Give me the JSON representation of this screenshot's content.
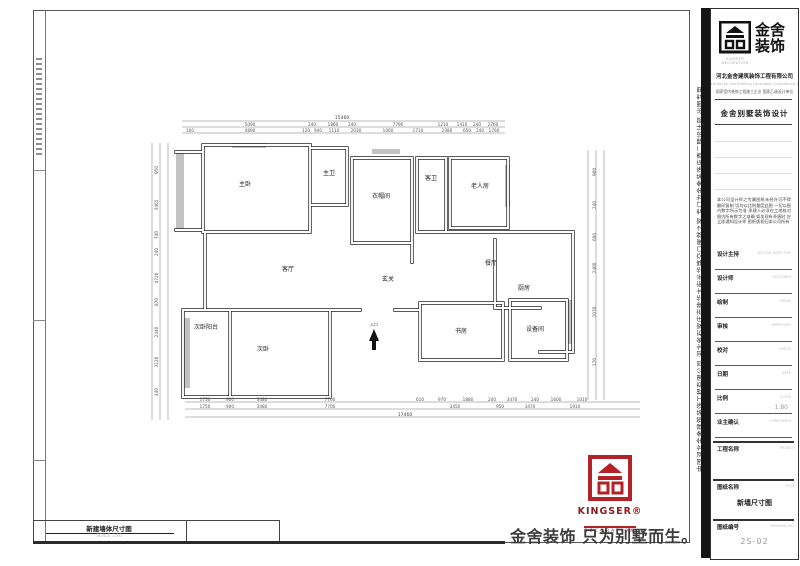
{
  "side_strip": {
    "text": "中国河北金舍建筑装饰工程有限公司  河北省石家庄市建华大街光华路交口居然之家  专门为金舍装饰店面二期设计部  出图专用"
  },
  "title_block": {
    "brand_line1": "金舍",
    "brand_line2": "装饰",
    "logo_sub": "KINGSER DECORATION",
    "company_cn": "河北金舍建筑装饰工程有限公司",
    "company_en": "He Bei Jin She Building Decoration Engineering Co.,Ltd.",
    "qualification": "国家室内装饰工程施工企业 国家乙级设计单位",
    "dept_title": "金舍别墅装饰设计",
    "notice": "本公司设计师之专属图纸未经许可不得翻印复制 切勿以比例量度此图 一切以图内数字所示为准 承建人必须在工地核对图内所有数字之准确 如发现有矛盾时 应立即通知设计师 图纸版权归本公司所有",
    "fields": [
      {
        "label": "设计主持",
        "en": "DESIGN DIRECTOR",
        "value": ""
      },
      {
        "label": "设计师",
        "en": "DESIGNER",
        "value": ""
      },
      {
        "label": "绘制",
        "en": "DRAW",
        "value": ""
      },
      {
        "label": "审核",
        "en": "APPROVED",
        "value": ""
      },
      {
        "label": "校对",
        "en": "CHECK",
        "value": ""
      },
      {
        "label": "日期",
        "en": "DATE",
        "value": ""
      },
      {
        "label": "比例",
        "en": "SCALE",
        "value": "1:80"
      },
      {
        "label": "业主确认",
        "en": "CONFIRMED",
        "value": ""
      }
    ],
    "project_label": "工程名称",
    "project_en": "PROJECT",
    "sheet_name_label": "图纸名称",
    "sheet_name_en": "TITLE",
    "sheet_name": "新墙尺寸图",
    "sheet_no_label": "图纸编号",
    "sheet_no_en": "DRAWING NO.",
    "sheet_no": "2S-02"
  },
  "footer": {
    "kingser_en": "KINGSER®",
    "kingser_sub": "DECORATION",
    "slogan": "金舍装饰 只为别墅而生。"
  },
  "bottom_label": {
    "title": "新建墙体尺寸图",
    "scale": "SCALE  1:80"
  },
  "plan": {
    "rooms": [
      "主卧",
      "主卫",
      "衣帽间",
      "客卫",
      "老人房",
      "客厅",
      "玄关",
      "餐厅",
      "厨房",
      "书房",
      "设备间",
      "次卧阳台",
      "次卧"
    ],
    "entrance_label": "入口",
    "dims": {
      "top_total": "15460",
      "top_row1": [
        "5090",
        "240",
        "1860",
        "240",
        "7790",
        "1210",
        "1410",
        "240",
        "2760"
      ],
      "top_row2": [
        "100",
        "4890",
        "120",
        "940",
        "1110",
        "2030",
        "1060",
        "1710",
        "2380",
        "650",
        "240",
        "1760"
      ],
      "bottom_row1": [
        "1750",
        "900",
        "3480",
        "7700",
        "610",
        "970",
        "1880",
        "240",
        "3470",
        "240",
        "1600",
        "1010"
      ],
      "bottom_row2": [
        "1750",
        "900",
        "3480",
        "7700",
        "3450",
        "950",
        "3470",
        "1910"
      ],
      "bottom_total": "17460",
      "left": [
        "950",
        "3465",
        "740",
        "240",
        "4720",
        "870",
        "2440",
        "3120",
        "440"
      ],
      "right": [
        "900",
        "240",
        "600",
        "2400",
        "2070",
        "170"
      ]
    }
  }
}
